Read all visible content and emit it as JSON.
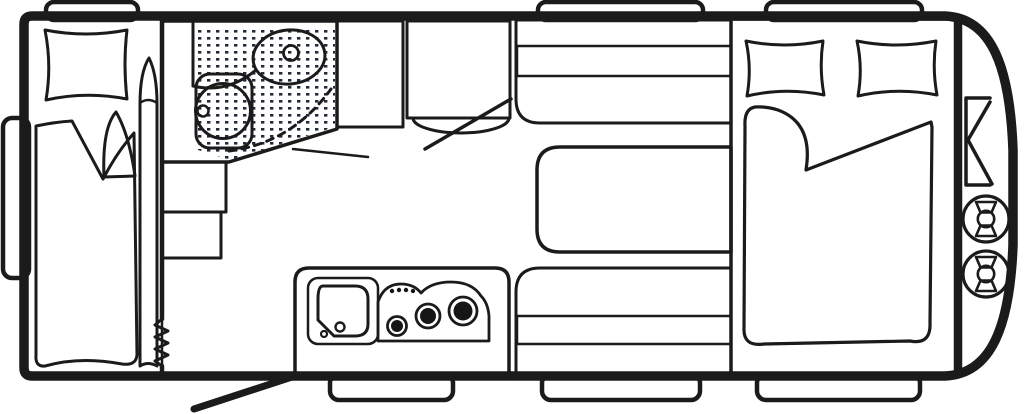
{
  "meta": {
    "kind": "caravan-floorplan-top-view"
  },
  "icons": {
    "freezer_glyph": "❄"
  },
  "inventory": {
    "windows_top": 3,
    "windows_bottom": 3,
    "windows_side": 1,
    "rear_single_beds": 2,
    "front_double_bed_pillows": 2,
    "stove_burners": 3,
    "gas_bottles": 2,
    "areas": [
      "rear-bedroom",
      "washroom",
      "fridge",
      "wardrobe",
      "dinette",
      "kitchen",
      "front-bedroom",
      "gas-locker"
    ]
  },
  "colors": {
    "background": "#ffffff",
    "wall": "#1b1b1b",
    "floor": "#F1EDE4",
    "platform": "#E4DFD3",
    "cushion": "#A9AFB6",
    "wood": "#D2A466",
    "bathroom": "#CBDCF1",
    "toilet": "#EDF2FA",
    "window": "#FFFFFF",
    "fixture_white": "#FFFFFF",
    "burner": "#161616",
    "shower_dot": "#222B38",
    "locker_floor": "#EFEBE2"
  }
}
